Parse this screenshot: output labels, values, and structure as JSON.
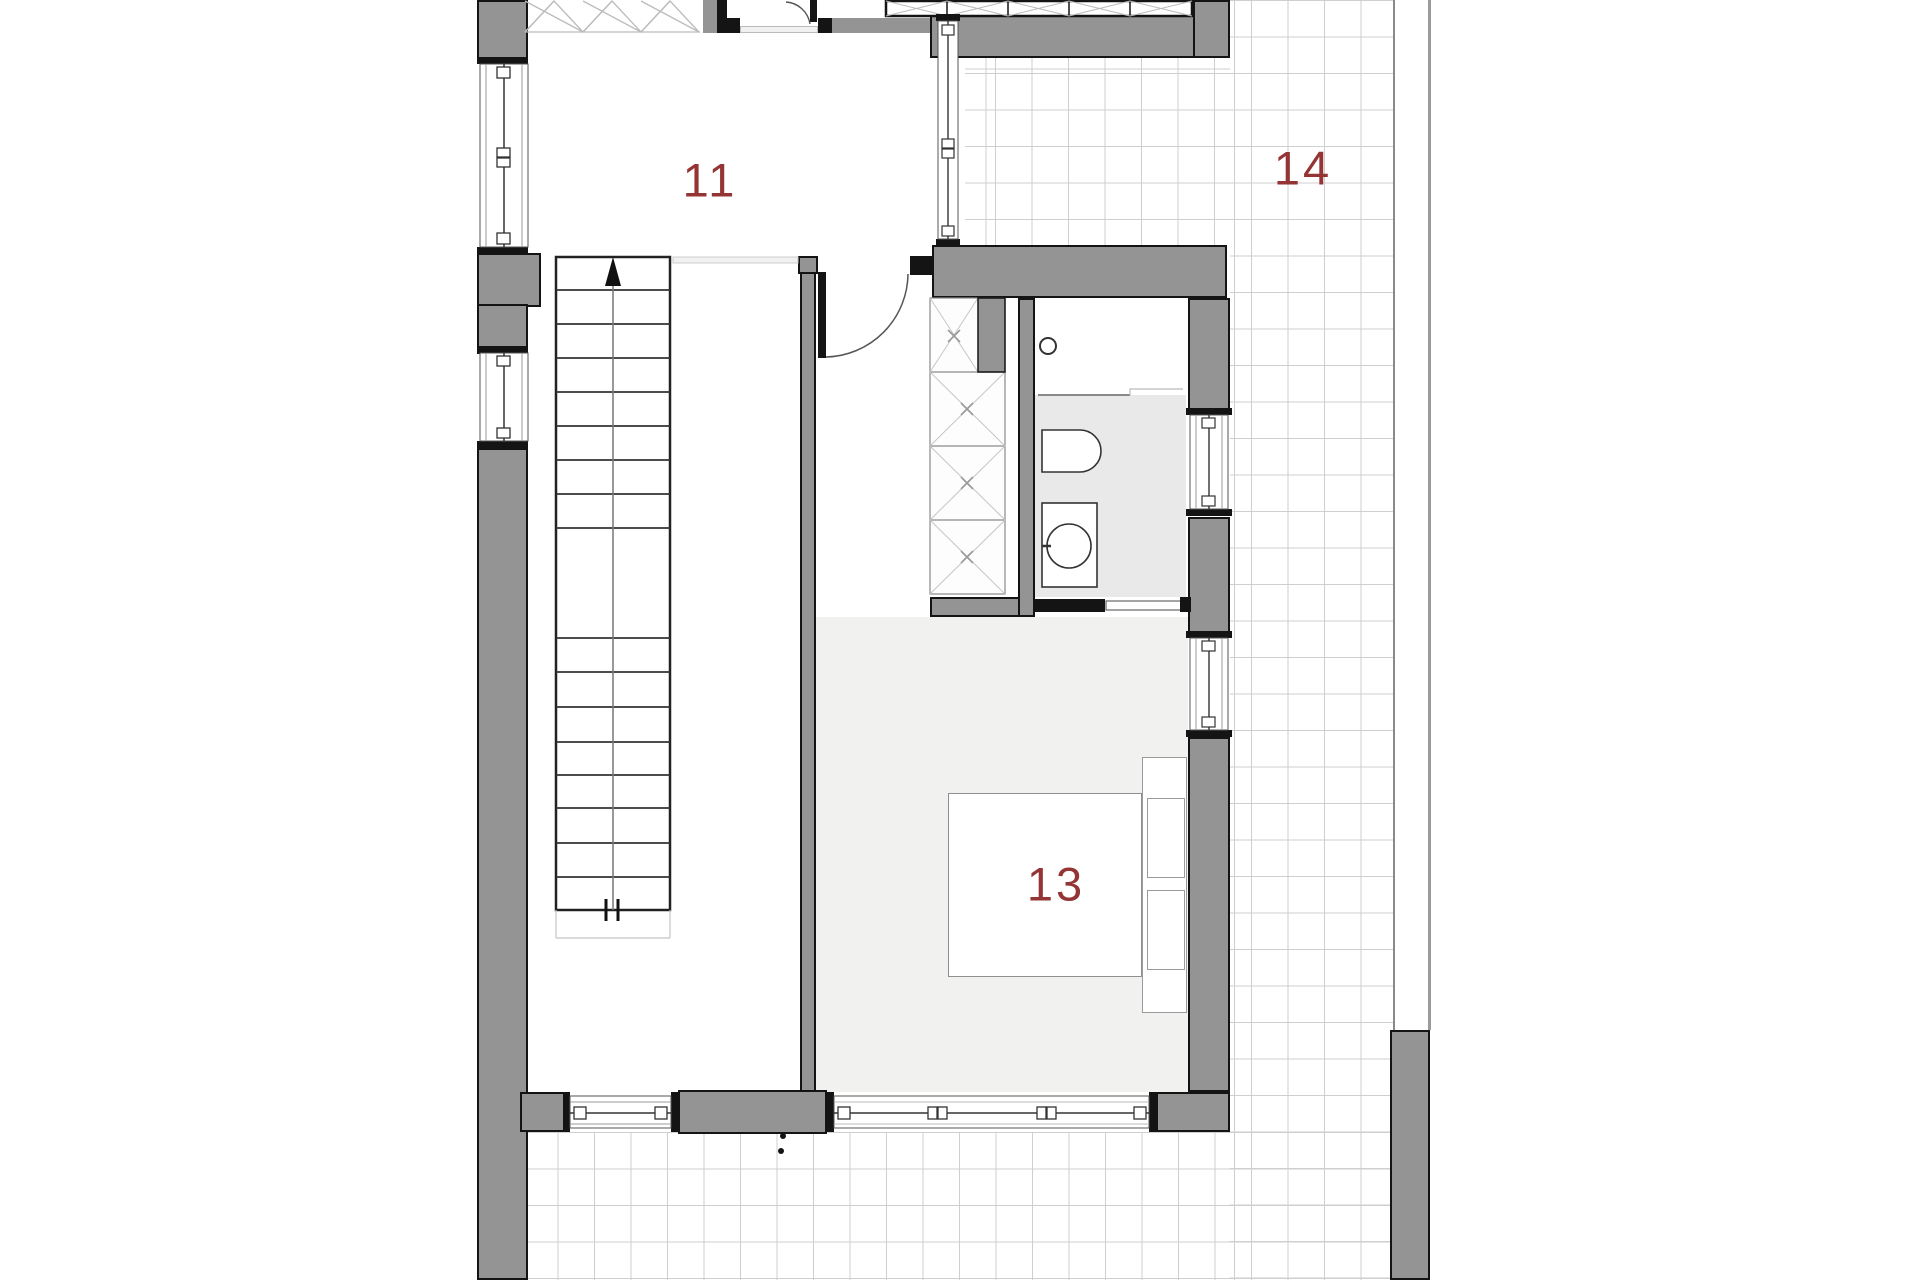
{
  "plan": {
    "rooms": [
      {
        "id": "room-11",
        "label": "11"
      },
      {
        "id": "room-13",
        "label": "13"
      },
      {
        "id": "room-14",
        "label": "14"
      }
    ]
  },
  "palette": {
    "wall": "#949494",
    "outline": "#141414",
    "label": "#943434",
    "floor_light": "#f1f1f0",
    "floor_bath": "#e9e9e9",
    "grid_line": "#cfcfcf",
    "hatch_line": "#bcbcbc"
  }
}
